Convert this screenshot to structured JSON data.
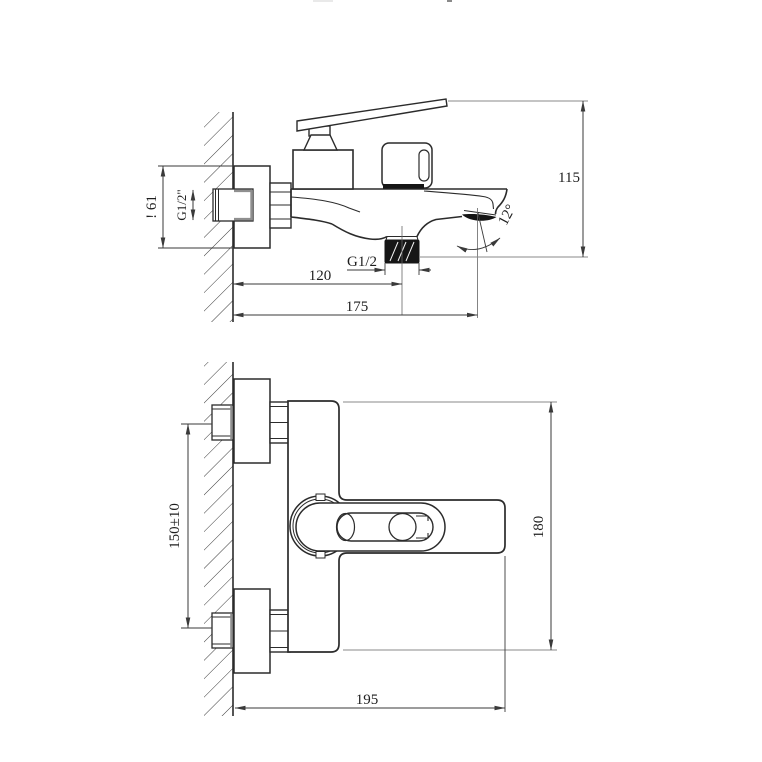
{
  "drawing": {
    "kind": "technical-drawing",
    "colors": {
      "background": "#ffffff",
      "outline": "#2b2b2b",
      "dimension": "#3a3a3a",
      "hatch": "#3a3a3a",
      "washer_gray": "#8f8f8f"
    },
    "side_view": {
      "dim_overall_height": "115",
      "dim_escutcheon_height": "! 61",
      "dim_inlet_thread": "G1/2\"",
      "dim_outlet_thread": "G1/2",
      "dim_wall_to_outlet": "120",
      "dim_wall_to_spout": "175",
      "dim_spout_angle": "12°"
    },
    "front_view": {
      "dim_inlet_spacing": "150±10",
      "dim_overall_height": "180",
      "dim_overall_length": "195"
    }
  }
}
